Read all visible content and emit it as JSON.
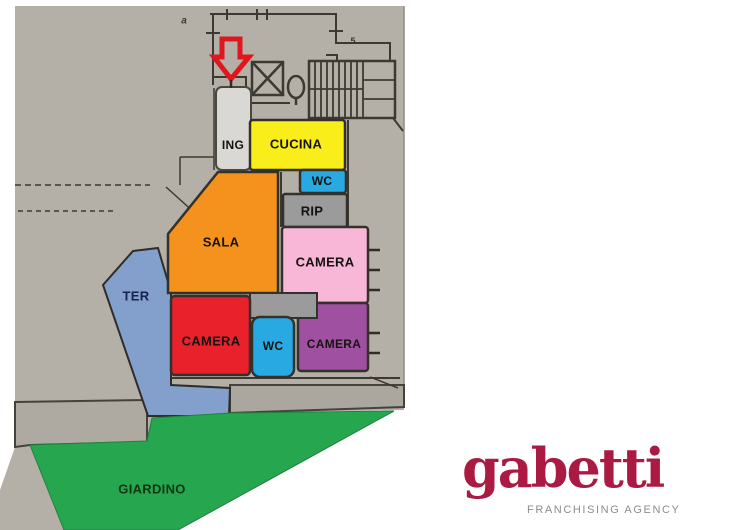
{
  "plan": {
    "paper_color": "#b4b0a7",
    "block_color": "#aeaaa1",
    "strip_color": "#aba79e",
    "hallway_color": "#9b9b9b",
    "wall_color": "#3c3933",
    "arrow_color": "#e0161f",
    "annotations": {
      "letter_a": "a",
      "number_5": "5"
    },
    "rooms": [
      {
        "name": "ing",
        "label": "ING",
        "color": "#d9d8d4",
        "label_color": "#15130f"
      },
      {
        "name": "cucina",
        "label": "CUCINA",
        "color": "#f9ed1a",
        "label_color": "#15130f"
      },
      {
        "name": "wc-top",
        "label": "WC",
        "color": "#29a9e1",
        "label_color": "#15130f"
      },
      {
        "name": "rip",
        "label": "RIP",
        "color": "#9b9b9b",
        "label_color": "#15130f"
      },
      {
        "name": "sala",
        "label": "SALA",
        "color": "#f5921e",
        "label_color": "#15130f"
      },
      {
        "name": "camera-pink",
        "label": "CAMERA",
        "color": "#f9b7d8",
        "label_color": "#15130f"
      },
      {
        "name": "ter",
        "label": "TER",
        "color": "#82a0cb",
        "label_color": "#15244d"
      },
      {
        "name": "camera-red",
        "label": "CAMERA",
        "color": "#e8212a",
        "label_color": "#15130f"
      },
      {
        "name": "wc-bottom",
        "label": "WC",
        "color": "#29a9e1",
        "label_color": "#15130f"
      },
      {
        "name": "camera-purple",
        "label": "CAMERA",
        "color": "#a050a0",
        "label_color": "#15130f"
      },
      {
        "name": "giardino",
        "label": "GIARDINO",
        "color": "#27a650",
        "label_color": "#0d3512"
      }
    ]
  },
  "logo": {
    "brand": "gabetti",
    "brand_color": "#ab1a43",
    "tagline": "FRANCHISING AGENCY",
    "tagline_color": "#8d8d8d"
  }
}
